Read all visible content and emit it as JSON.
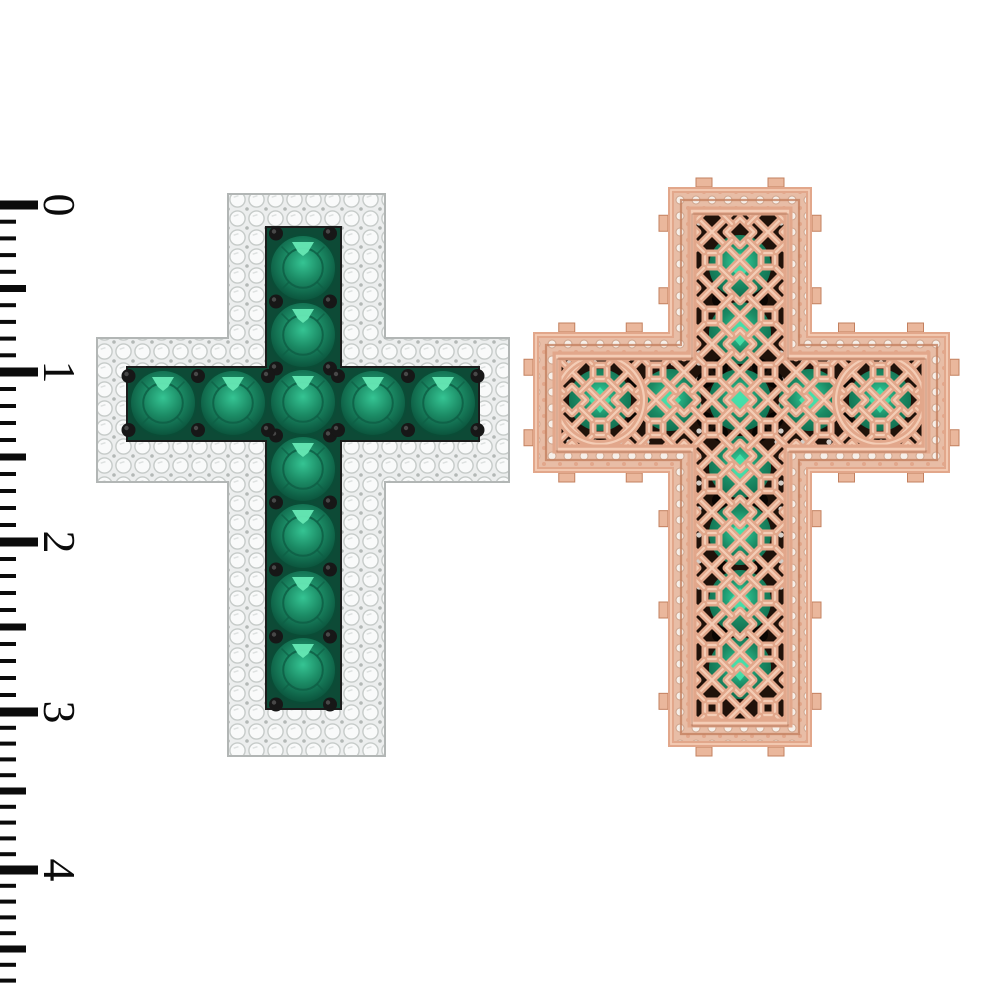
{
  "meta": {
    "kind": "jewelry-product-render",
    "description": "Front and back 3D render of an emerald and diamond cross pendant beside a centimeter ruler",
    "background": "#ffffff"
  },
  "colors": {
    "ruler_ink": "#0b0b0b",
    "pave_bg": "#eceeee",
    "pave_stone": "#f9fafa",
    "pave_stroke": "#c6cbc9",
    "pave_dot": "#b3b8b6",
    "cross_outline": "#b2b6b5",
    "channel_fill": "#0d4a36",
    "channel_stroke": "#1b1b1b",
    "emerald_core": "#35c493",
    "emerald_mid": "#1b8a64",
    "emerald_deep": "#0e5f45",
    "emerald_rim": "#0a4c36",
    "emerald_glint": "#66e8b4",
    "prong": "#171717",
    "prong_hi": "#555555",
    "rose_light": "#f4cdb6",
    "rose_mid": "#e2a78b",
    "rose_dark": "#c3805f",
    "rose_deep": "#9c5f44",
    "tab_fill": "#eab79c",
    "gap_bg": "#e8bda6",
    "gap_stone": "#f6efe9",
    "gap_stroke": "#cfa58d",
    "panel_bg": "#20120a",
    "back_black": "#0a0502",
    "back_emerald_core": "#36d6a2",
    "back_emerald_deep": "#0f6b4d",
    "back_glint": "#49e0ab",
    "sparkle": "#f5efe9"
  },
  "ruler": {
    "labels": [
      "0",
      "1",
      "2",
      "3",
      "4"
    ],
    "unit_ys": [
      205,
      372,
      542,
      712,
      870
    ],
    "minor_per_unit": 10,
    "extra_minor_ticks": 7,
    "len_major": 38,
    "len_half": 26,
    "len_minor": 16,
    "th_major": 9,
    "th_half": 7,
    "th_minor": 4,
    "label_x": 44,
    "label_font_size": 46
  },
  "front_cross": {
    "v_arm": {
      "x": 228,
      "y": 194,
      "w": 157,
      "h": 562
    },
    "h_arm": {
      "x": 97,
      "y": 338,
      "w": 412,
      "h": 144
    },
    "channel_v": {
      "x": 267,
      "y": 228,
      "w": 73,
      "h": 480
    },
    "channel_h": {
      "x": 128,
      "y": 368,
      "w": 350,
      "h": 72
    },
    "stones_v": {
      "cx": 303,
      "cys": [
        268,
        335,
        402,
        469,
        536,
        603,
        670
      ]
    },
    "stones_h": {
      "cy": 403,
      "cxs": [
        163,
        233,
        303,
        373,
        443
      ]
    },
    "stone_r": 33,
    "prong_r": 7,
    "prong_offset": 27,
    "pave_cell": 19
  },
  "back_cross": {
    "v_arm": {
      "x": 668,
      "y": 187,
      "w": 144,
      "h": 560
    },
    "h_arm": {
      "x": 533,
      "y": 332,
      "w": 417,
      "h": 141
    },
    "frame_inset": 3,
    "mid_line_inset": 13,
    "panel_inset": 24,
    "stones_v": {
      "cx": 740,
      "cys": [
        266,
        333,
        400,
        467,
        534,
        601,
        668
      ]
    },
    "stones_h": {
      "cy": 400,
      "cxs": [
        600,
        670,
        740,
        810,
        880
      ]
    },
    "stone_r": 31,
    "ring_r": 44,
    "lattice_cell": 56,
    "tab_len": 16,
    "tab_out": 9,
    "tab_spacing": 85,
    "sparkle_step": 26
  }
}
